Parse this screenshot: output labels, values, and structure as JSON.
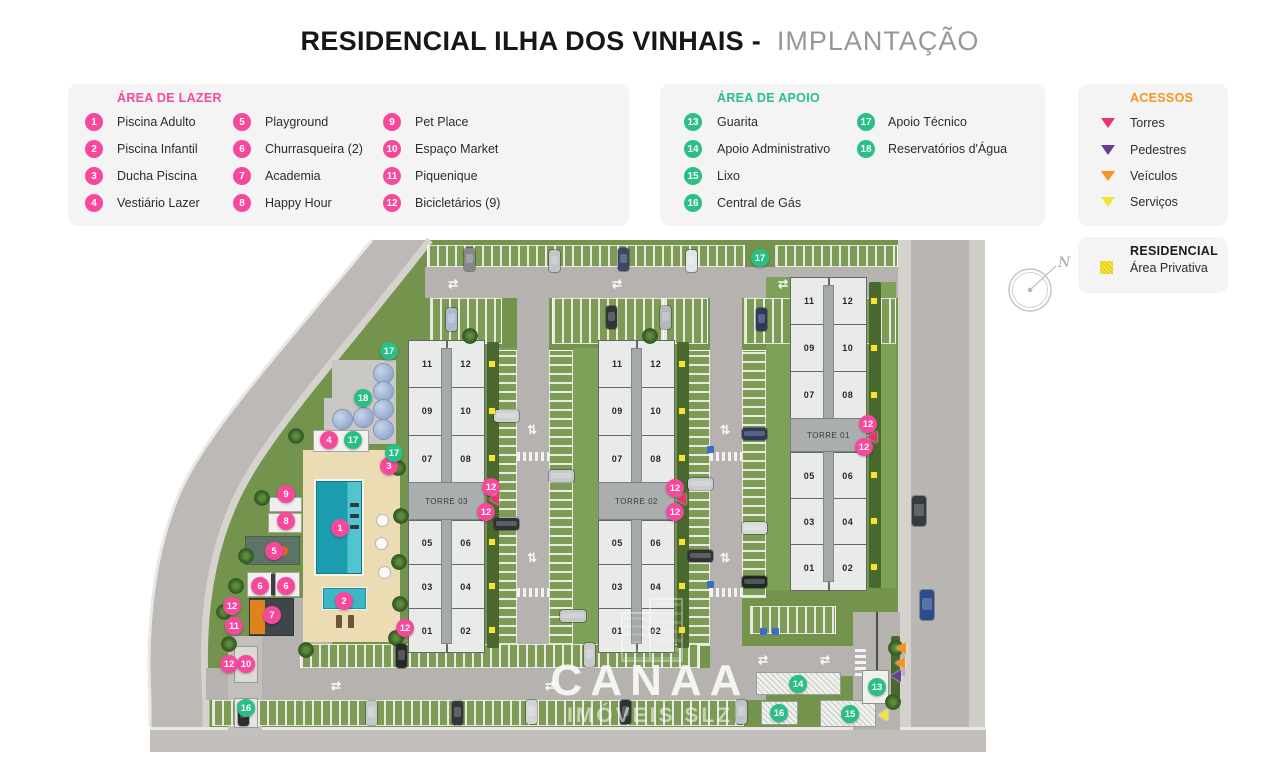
{
  "title": {
    "main": "RESIDENCIAL ILHA DOS VINHAIS -",
    "sub": "IMPLANTAÇÃO"
  },
  "colors": {
    "lazer": "#f8489c",
    "apoio": "#2abf85",
    "acessos": "#f8941d"
  },
  "legend_lazer": {
    "header": "ÁREA DE LAZER",
    "items": [
      {
        "n": "1",
        "label": "Piscina Adulto"
      },
      {
        "n": "2",
        "label": "Piscina Infantil"
      },
      {
        "n": "3",
        "label": "Ducha Piscina"
      },
      {
        "n": "4",
        "label": "Vestiário Lazer"
      },
      {
        "n": "5",
        "label": "Playground"
      },
      {
        "n": "6",
        "label": "Churrasqueira (2)"
      },
      {
        "n": "7",
        "label": "Academia"
      },
      {
        "n": "8",
        "label": "Happy Hour"
      },
      {
        "n": "9",
        "label": "Pet Place"
      },
      {
        "n": "10",
        "label": "Espaço Market"
      },
      {
        "n": "11",
        "label": "Piquenique"
      },
      {
        "n": "12",
        "label": "Bicicletários (9)"
      }
    ]
  },
  "legend_apoio": {
    "header": "ÁREA DE APOIO",
    "items": [
      {
        "n": "13",
        "label": "Guarita"
      },
      {
        "n": "14",
        "label": "Apoio Administrativo"
      },
      {
        "n": "15",
        "label": "Lixo"
      },
      {
        "n": "16",
        "label": "Central de Gás"
      },
      {
        "n": "17",
        "label": "Apoio Técnico"
      },
      {
        "n": "18",
        "label": "Reservatórios d'Água"
      }
    ]
  },
  "legend_acessos": {
    "header": "ACESSOS",
    "items": [
      {
        "label": "Torres",
        "color": "#e8316e"
      },
      {
        "label": "Pedestres",
        "color": "#6a3d96"
      },
      {
        "label": "Veículos",
        "color": "#f8941d"
      },
      {
        "label": "Serviços",
        "color": "#f2e438"
      }
    ]
  },
  "legend_residencial": {
    "header": "RESIDENCIAL",
    "items": [
      {
        "label": "Área Privativa",
        "color": "#f2e438"
      }
    ]
  },
  "site": {
    "towers": [
      {
        "name": "TORRE 01",
        "units_top": [
          [
            "11",
            "12"
          ],
          [
            "09",
            "10"
          ],
          [
            "07",
            "08"
          ]
        ],
        "units_bottom": [
          [
            "05",
            "06"
          ],
          [
            "03",
            "04"
          ],
          [
            "01",
            "02"
          ]
        ]
      },
      {
        "name": "TORRE 02",
        "units_top": [
          [
            "11",
            "12"
          ],
          [
            "09",
            "10"
          ],
          [
            "07",
            "08"
          ]
        ],
        "units_bottom": [
          [
            "05",
            "06"
          ],
          [
            "03",
            "04"
          ],
          [
            "01",
            "02"
          ]
        ]
      },
      {
        "name": "TORRE 03",
        "units_top": [
          [
            "11",
            "12"
          ],
          [
            "09",
            "10"
          ],
          [
            "07",
            "08"
          ]
        ],
        "units_bottom": [
          [
            "05",
            "06"
          ],
          [
            "03",
            "04"
          ],
          [
            "01",
            "02"
          ]
        ]
      }
    ],
    "markers": [
      {
        "n": "1",
        "kind": "lazer",
        "x": 340,
        "y": 528
      },
      {
        "n": "2",
        "kind": "lazer",
        "x": 344,
        "y": 601
      },
      {
        "n": "3",
        "kind": "lazer",
        "x": 389,
        "y": 466
      },
      {
        "n": "4",
        "kind": "lazer",
        "x": 329,
        "y": 440
      },
      {
        "n": "5",
        "kind": "lazer",
        "x": 274,
        "y": 551
      },
      {
        "n": "6",
        "kind": "lazer",
        "x": 260,
        "y": 586
      },
      {
        "n": "6",
        "kind": "lazer",
        "x": 286,
        "y": 586
      },
      {
        "n": "7",
        "kind": "lazer",
        "x": 272,
        "y": 615
      },
      {
        "n": "8",
        "kind": "lazer",
        "x": 286,
        "y": 521
      },
      {
        "n": "9",
        "kind": "lazer",
        "x": 286,
        "y": 494
      },
      {
        "n": "10",
        "kind": "lazer",
        "x": 246,
        "y": 664
      },
      {
        "n": "11",
        "kind": "lazer",
        "x": 234,
        "y": 626
      },
      {
        "n": "12",
        "kind": "lazer",
        "x": 232,
        "y": 606
      },
      {
        "n": "12",
        "kind": "lazer",
        "x": 229,
        "y": 664
      },
      {
        "n": "12",
        "kind": "lazer",
        "x": 405,
        "y": 628
      },
      {
        "n": "12",
        "kind": "lazer",
        "x": 491,
        "y": 487
      },
      {
        "n": "12",
        "kind": "lazer",
        "x": 486,
        "y": 512
      },
      {
        "n": "12",
        "kind": "lazer",
        "x": 675,
        "y": 488
      },
      {
        "n": "12",
        "kind": "lazer",
        "x": 675,
        "y": 512
      },
      {
        "n": "12",
        "kind": "lazer",
        "x": 868,
        "y": 424
      },
      {
        "n": "12",
        "kind": "lazer",
        "x": 864,
        "y": 447
      },
      {
        "n": "13",
        "kind": "apoio",
        "x": 877,
        "y": 687
      },
      {
        "n": "14",
        "kind": "apoio",
        "x": 798,
        "y": 684
      },
      {
        "n": "15",
        "kind": "apoio",
        "x": 850,
        "y": 714
      },
      {
        "n": "16",
        "kind": "apoio",
        "x": 246,
        "y": 708
      },
      {
        "n": "16",
        "kind": "apoio",
        "x": 779,
        "y": 713
      },
      {
        "n": "17",
        "kind": "apoio",
        "x": 760,
        "y": 258
      },
      {
        "n": "17",
        "kind": "apoio",
        "x": 389,
        "y": 351
      },
      {
        "n": "17",
        "kind": "apoio",
        "x": 353,
        "y": 440
      },
      {
        "n": "17",
        "kind": "apoio",
        "x": 394,
        "y": 453
      },
      {
        "n": "18",
        "kind": "apoio",
        "x": 363,
        "y": 398
      }
    ],
    "triangles": [
      {
        "kind": "torres",
        "x": 494,
        "y": 499
      },
      {
        "kind": "torres",
        "x": 681,
        "y": 499
      },
      {
        "kind": "torres",
        "x": 872,
        "y": 437
      },
      {
        "kind": "veiculos",
        "x": 901,
        "y": 648
      },
      {
        "kind": "veiculos",
        "x": 900,
        "y": 663
      },
      {
        "kind": "pedestres",
        "x": 896,
        "y": 676
      },
      {
        "kind": "servicos",
        "x": 883,
        "y": 715
      }
    ],
    "access_colors": {
      "torres": "#e8316e",
      "pedestres": "#6a3d96",
      "veiculos": "#f8941d",
      "servicos": "#f2e438"
    },
    "compass_label": "N",
    "watermark": {
      "line1": "CANAA",
      "line2": "IMÓVEIS SLZ"
    }
  }
}
